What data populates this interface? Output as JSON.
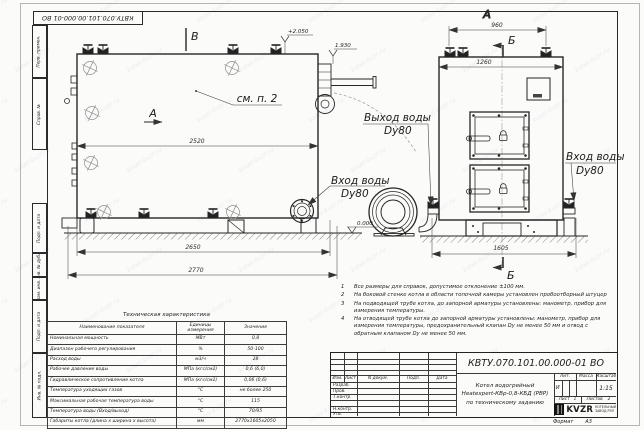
{
  "doc": {
    "number": "КВТУ.070.101.00.000-01 ВО",
    "format_label": "Формат",
    "format_value": "А3"
  },
  "frame_strip": {
    "labels": [
      "Перв. примен.",
      "Справ. №",
      "Подп. и дата",
      "Инв. № дубл.",
      "Взам. инв. №",
      "Подп. и дата",
      "Инв. № подл."
    ]
  },
  "drawing": {
    "view_v": "В",
    "view_a_side": "А",
    "section_a_top": "А",
    "section_b_top": "Б",
    "section_b_bottom": "Б",
    "see_item": "см. п. 2",
    "elev_top": "+2.050",
    "elev_mid": "1.930",
    "elev_zero": "0.000",
    "dim_2520": "2520",
    "dim_2650": "2650",
    "dim_2770": "2770",
    "dim_960": "960",
    "dim_1260": "1260",
    "dim_1605": "1605",
    "outlet_line1": "Выход воды",
    "outlet_line2": "Dy80",
    "inlet_left_line1": "Вход воды",
    "inlet_left_line2": "Dy80",
    "inlet_right_line1": "Вход воды",
    "inlet_right_line2": "Dy80"
  },
  "tech_table": {
    "title": "Техническая характеристика",
    "headers": [
      "Наименование показателя",
      "Единицы измерения",
      "Значение"
    ],
    "rows": [
      [
        "Номинальная мощность",
        "МВт",
        "0,8"
      ],
      [
        "Диапазон рабочего регулирования",
        "%",
        "50-100"
      ],
      [
        "Расход воды",
        "м3/ч",
        "28"
      ],
      [
        "Рабочее давление воды",
        "МПа (кгс/см2)",
        "0,6 (6,0)"
      ],
      [
        "Гидравлическое сопротивление котла",
        "МПа (кгс/см2)",
        "0,06 (0,6)"
      ],
      [
        "Температура уходящих газов",
        "°С",
        "не более 250"
      ],
      [
        "Максимальная рабочая температура воды",
        "°С",
        "115"
      ],
      [
        "Температура воды (Вход/выход)",
        "°С",
        "70/95"
      ],
      [
        "Габариты котла (длина х ширина х высота)",
        "мм",
        "2770х1605х2050"
      ]
    ]
  },
  "notes": [
    {
      "num": "1",
      "text": "Все размеры для справок, допустимое отклонение ±100 мм."
    },
    {
      "num": "2",
      "text": "На боковой стенке котла в области топочной камеры установлен пробоотборный штуцер"
    },
    {
      "num": "3",
      "text": "На подводящей трубе котла, до запорной арматуры установлены: манометр, прибор для измерения температуры."
    },
    {
      "num": "4",
      "text": "На отводящей трубе котла до запорной арматуры установлены: манометр, прибор для измерения температуры, предохранительный клапан Dу не менее 50 мм и отвод с обратным клапаном Dу не менее 50 мм."
    }
  ],
  "title_block": {
    "doc_number": "КВТУ.070.101.00.000-01 ВО",
    "name_line1": "Котел водогрейный",
    "name_line2": "Heatexpert-КВр-0,8-КБД (РВР)",
    "name_line3": "по техническому заданию",
    "header_row": [
      "Изм.",
      "Лист",
      "N докум.",
      "Подп.",
      "Дата"
    ],
    "roles": [
      "Разраб.",
      "Пров.",
      "Т.контр.",
      "",
      "Н.контр.",
      "Утв."
    ],
    "lit_label": "Лит.",
    "lit_value": "И",
    "mass_label": "Масса",
    "scale_label": "Масштаб",
    "scale_value": "1:15",
    "sheet_label": "Лист",
    "sheet_value": "1",
    "sheets_label": "Листов",
    "sheets_value": "2",
    "logo_word": "KVZR",
    "logo_sub1": "КОТЕЛЬНЫЙ",
    "logo_sub2": "ЗАВОД РЭП"
  },
  "watermark": "kotel-kvzr.ru"
}
